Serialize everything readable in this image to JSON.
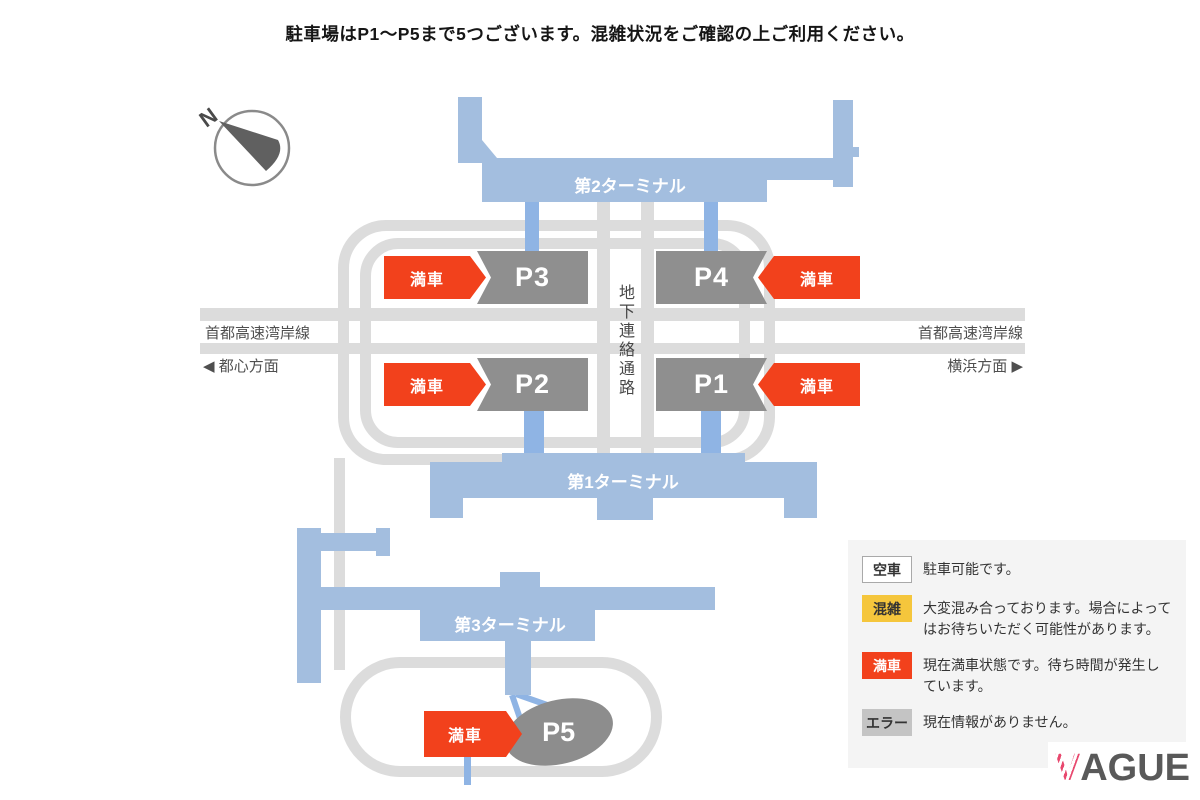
{
  "title": "駐車場はP1〜P5まで5つございます。混雑状況をご確認の上ご利用ください。",
  "compass": {
    "north": "N"
  },
  "map": {
    "terminals": [
      {
        "id": "terminal-2",
        "label": "第2ターミナル"
      },
      {
        "id": "terminal-1",
        "label": "第1ターミナル"
      },
      {
        "id": "terminal-3",
        "label": "第3ターミナル"
      }
    ],
    "parkings": [
      {
        "id": "P3",
        "label": "P3",
        "status": "満車"
      },
      {
        "id": "P4",
        "label": "P4",
        "status": "満車"
      },
      {
        "id": "P2",
        "label": "P2",
        "status": "満車"
      },
      {
        "id": "P1",
        "label": "P1",
        "status": "満車"
      },
      {
        "id": "P5",
        "label": "P5",
        "status": "満車"
      }
    ],
    "roads": {
      "highway_left": "首都高速湾岸線",
      "highway_right": "首都高速湾岸線",
      "toward_city": "◀ 都心方面",
      "toward_yokohama": "横浜方面 ▶",
      "underground_passage": "地下連絡通路"
    }
  },
  "legend": {
    "items": [
      {
        "badge": "空車",
        "desc": "駐車可能です。",
        "bg": "#ffffff",
        "fg": "#333333"
      },
      {
        "badge": "混雑",
        "desc": "大変混み合っております。場合によってはお待ちいただく可能性があります。",
        "bg": "#f5c63c",
        "fg": "#333333"
      },
      {
        "badge": "満車",
        "desc": "現在満車状態です。待ち時間が発生しています。",
        "bg": "#f2411c",
        "fg": "#ffffff"
      },
      {
        "badge": "エラー",
        "desc": "現在情報がありません。",
        "bg": "#c4c4c4",
        "fg": "#333333"
      }
    ]
  },
  "logo": {
    "v": "V",
    "rest": "AGUE"
  },
  "colors": {
    "terminal_blue": "#a3bedf",
    "connector_blue": "#8fb4e4",
    "road_gray": "#dcdcdc",
    "parking_gray": "#8f8f8f",
    "status_full_red": "#f2411c",
    "status_crowded_yellow": "#f5c63c",
    "status_error_gray": "#c4c4c4",
    "legend_background": "#f4f4f4"
  }
}
